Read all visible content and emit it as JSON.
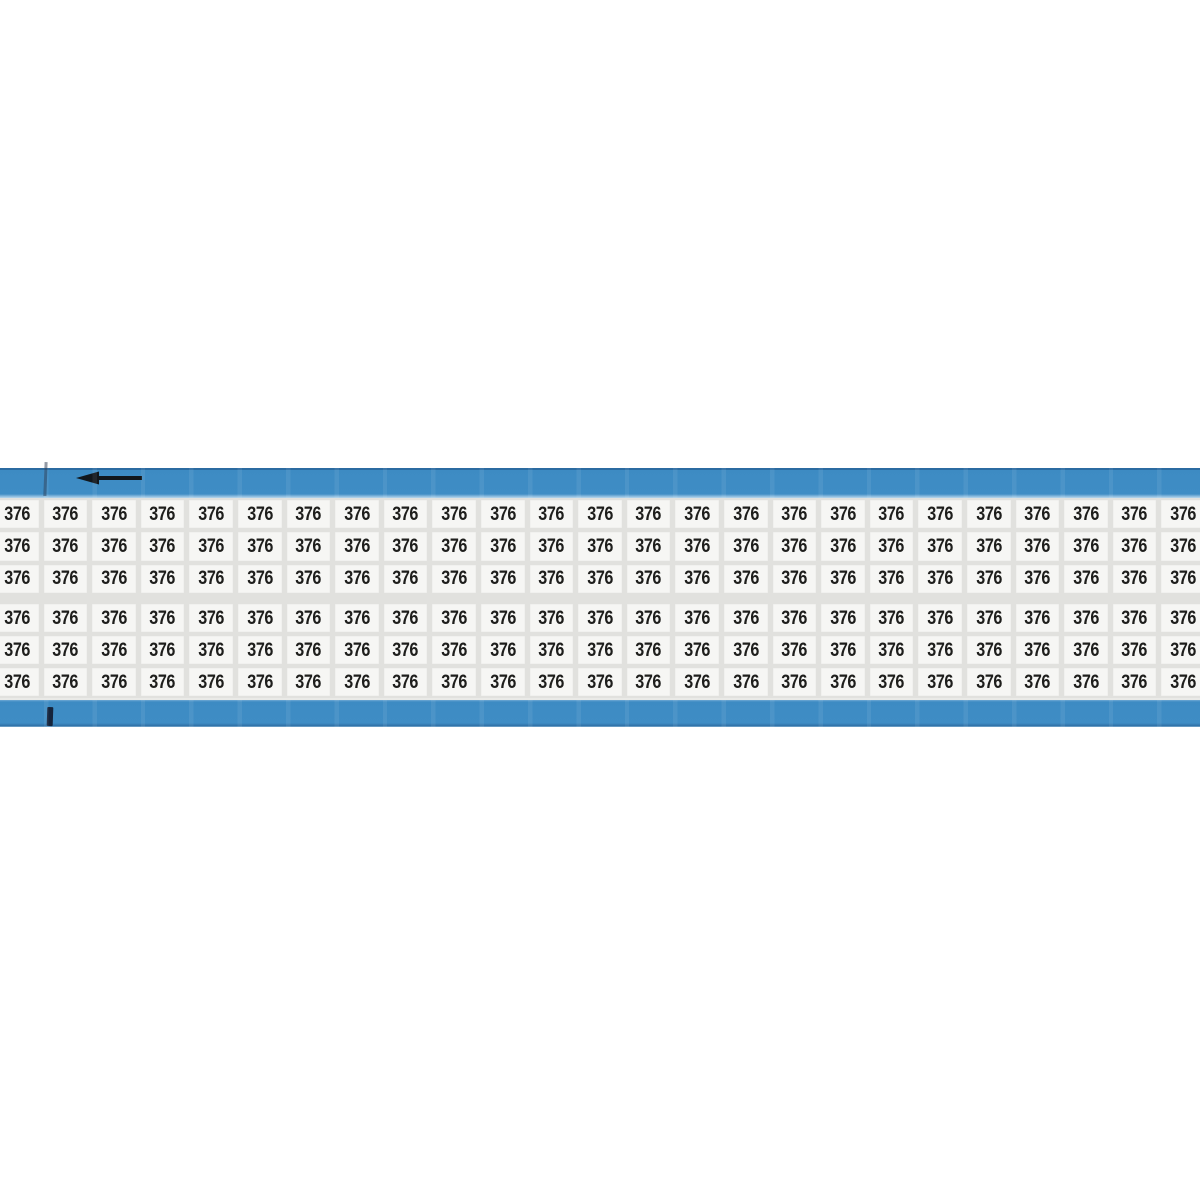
{
  "card": {
    "label_value": "376",
    "columns_per_row": 25,
    "rows_per_group": 3,
    "group_count": 2,
    "total_labels": 150,
    "colors": {
      "tape_blue": "#3d8bc3",
      "tape_blue_edge": "#2b6ba1",
      "label_background": "#f6f6f4",
      "label_gap": "#e1e1de",
      "text": "#1e1e1c",
      "mark_black": "#15243c",
      "page_background": "#ffffff"
    },
    "icons": {
      "arrow": {
        "name": "left-arrow-icon",
        "direction": "left",
        "color": "#0d0d0d"
      },
      "marks": [
        "registration-tick-top-left",
        "registration-tick-bottom-left"
      ]
    }
  }
}
